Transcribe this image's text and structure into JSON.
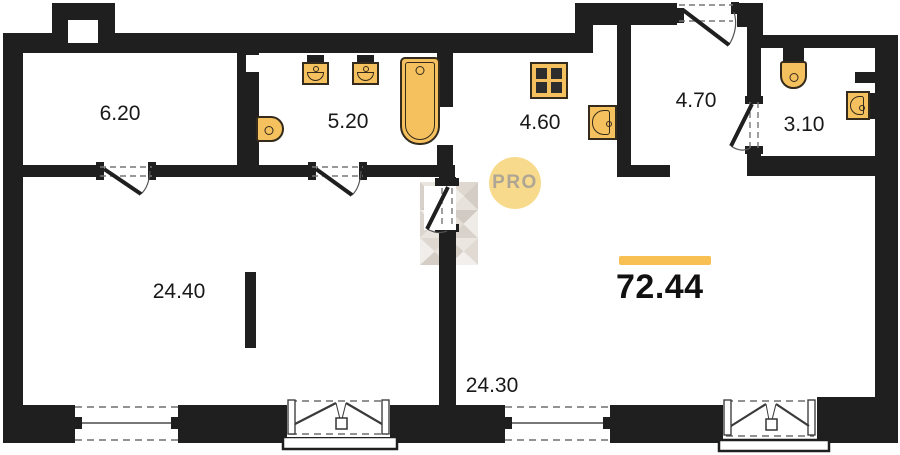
{
  "floorplan": {
    "total_area": "72.44",
    "watermark": "PRO",
    "rooms": [
      {
        "name": "top-left-room",
        "area": "6.20"
      },
      {
        "name": "bathroom",
        "area": "5.20"
      },
      {
        "name": "kitchen-niche",
        "area": "4.60"
      },
      {
        "name": "entrance-hall",
        "area": "4.70"
      },
      {
        "name": "wc",
        "area": "3.10"
      },
      {
        "name": "living-room-left",
        "area": "24.40"
      },
      {
        "name": "living-room-right",
        "area": "24.30"
      }
    ],
    "fixtures": {
      "bathroom_5_20": [
        "toilet",
        "washbasin",
        "washbasin",
        "bathtub"
      ],
      "kitchen_4_60": [
        "stove",
        "sink"
      ],
      "wc_3_10": [
        "toilet",
        "washbasin"
      ]
    },
    "colors": {
      "wall": "#1f1f1f",
      "fixture_fill": "#F5C05E",
      "fixture_outline": "#342b1c",
      "accent_bar": "#F8C052",
      "watermark_circle": "#F7DA8C",
      "watermark_text": "#AFA595"
    }
  }
}
